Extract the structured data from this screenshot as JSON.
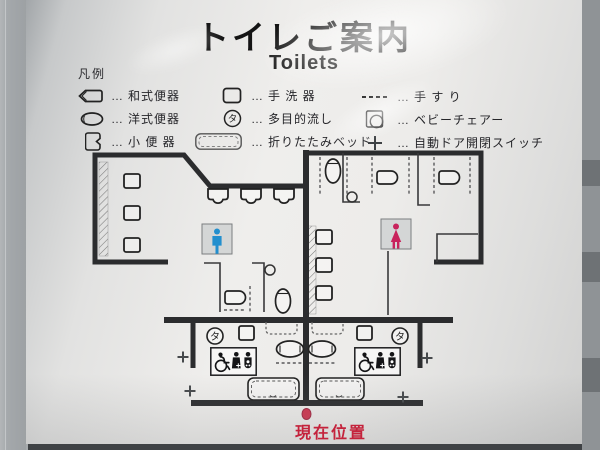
{
  "header": {
    "title": "トイレご案内",
    "subtitle": "Toilets"
  },
  "legend": {
    "heading": "凡例",
    "separator": "…",
    "columns": [
      {
        "items": [
          {
            "icon": "squat-toilet-icon",
            "label": "和式便器"
          },
          {
            "icon": "western-toilet-icon",
            "label": "洋式便器"
          },
          {
            "icon": "urinal-icon",
            "label": "小 便 器"
          }
        ]
      },
      {
        "items": [
          {
            "icon": "hand-basin-icon",
            "label": "手 洗 器"
          },
          {
            "icon": "multipurpose-sink-icon",
            "label": "多目的流し"
          },
          {
            "icon": "folding-bed-icon",
            "label": "折りたたみベッド"
          }
        ]
      },
      {
        "items": [
          {
            "icon": "handrail-icon",
            "label": "手 す り"
          },
          {
            "icon": "baby-chair-icon",
            "label": "ベビーチェアー"
          },
          {
            "icon": "auto-door-switch-icon",
            "label": "自動ドア開閉スイッチ"
          }
        ]
      }
    ]
  },
  "glyphs": {
    "multipurpose_sink": "タ"
  },
  "map": {
    "rooms": [
      {
        "pictogram": "men-pictogram",
        "color": "#238fce"
      },
      {
        "pictogram": "women-pictogram",
        "color": "#c8235c"
      }
    ]
  },
  "footer": {
    "current_location": "現在位置"
  },
  "colors": {
    "wall": "#2b2c2e",
    "men_blue": "#238fce",
    "women_pink": "#c8235c",
    "current_location_red": "#c4233c"
  }
}
